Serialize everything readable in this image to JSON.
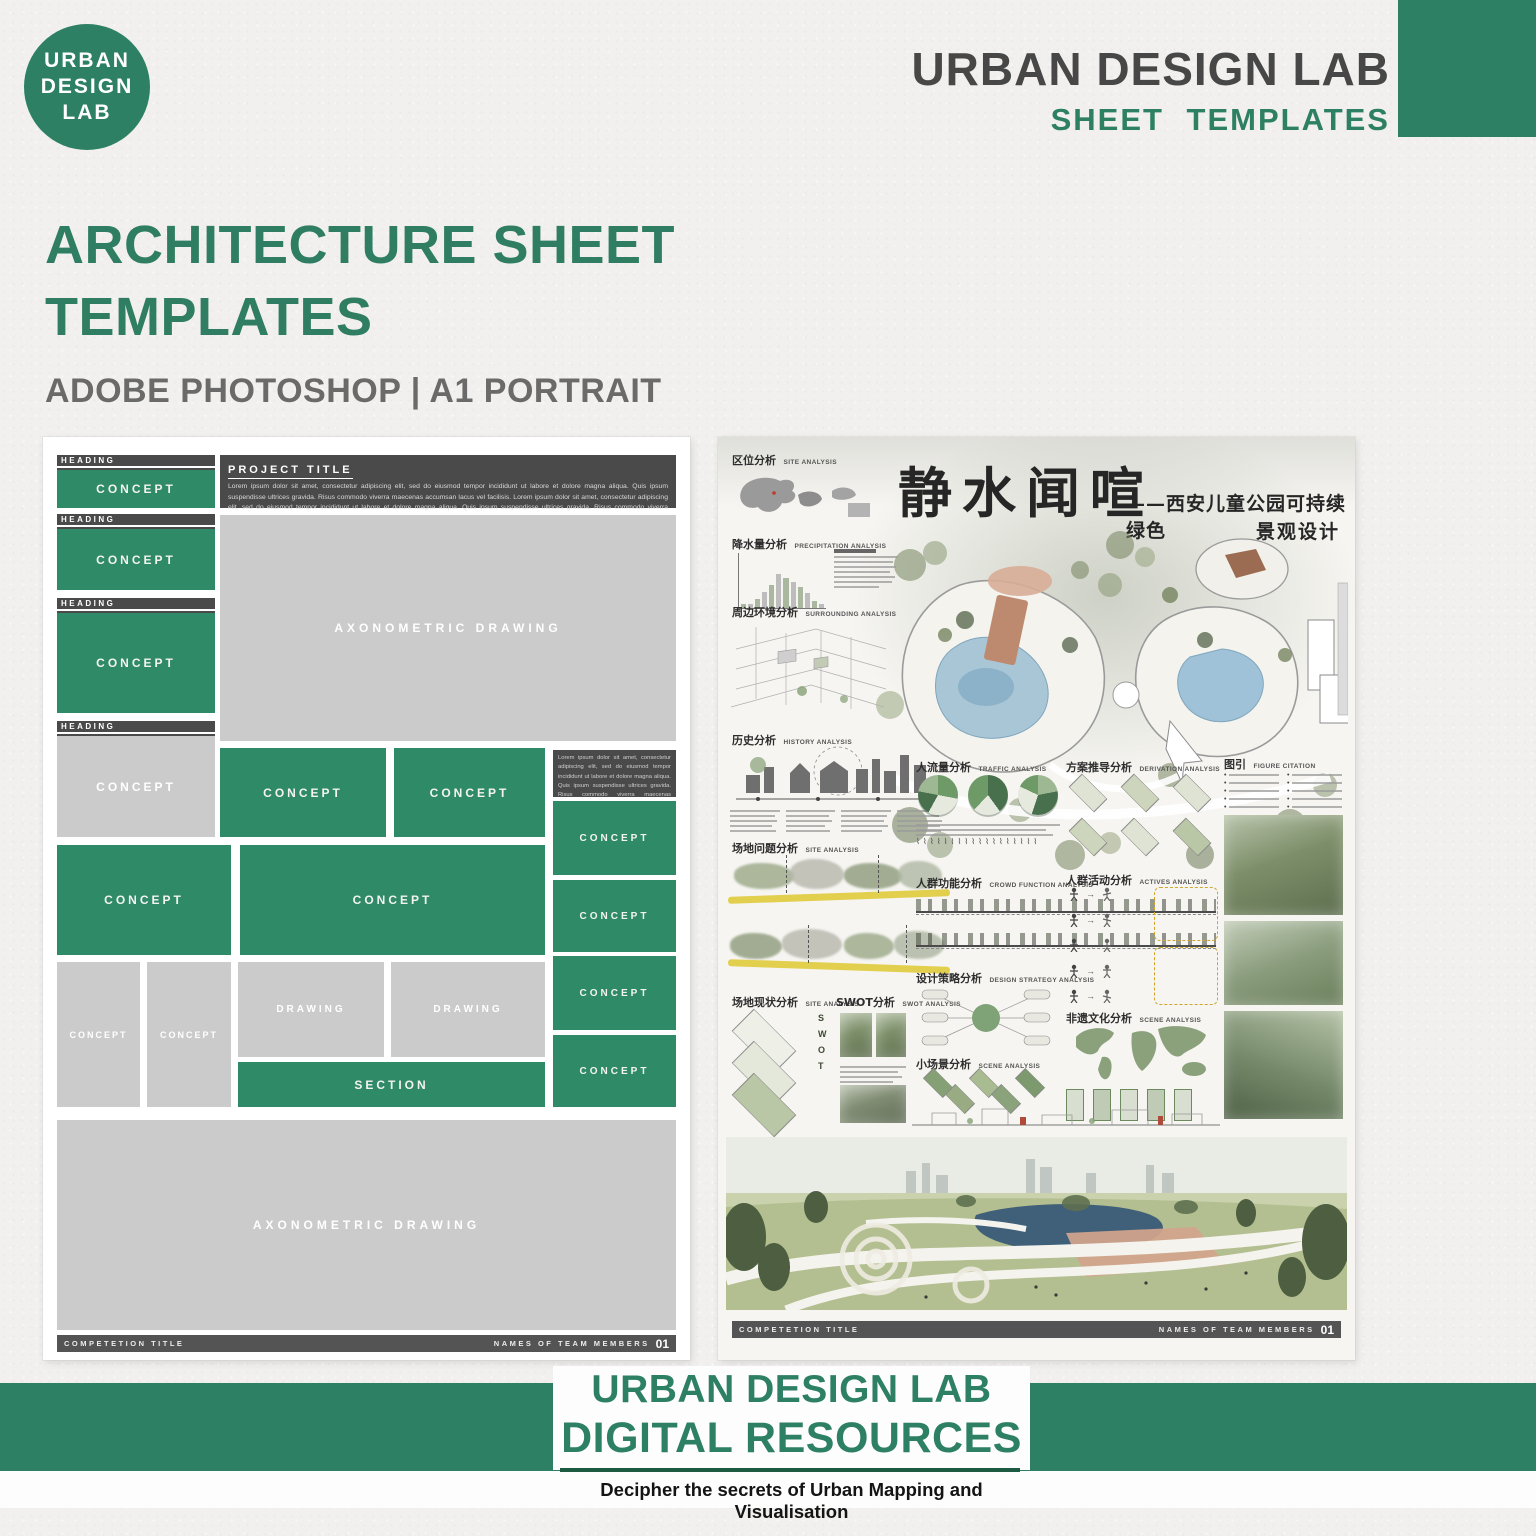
{
  "colors": {
    "brand_green": "#2E8064",
    "template_green": "#2F8A68",
    "dark_gray": "#4A4A4A",
    "block_gray": "#CBCBCB",
    "hero_green": "#2F7D62"
  },
  "header": {
    "logo_lines": [
      "URBAN",
      "DESIGN",
      "LAB"
    ],
    "brand_title": "URBAN DESIGN LAB",
    "brand_subtitle": "SHEET TEMPLATES"
  },
  "hero": {
    "title_line1": "ARCHITECTURE SHEET",
    "title_line2": "TEMPLATES",
    "subtitle": "ADOBE PHOTOSHOP | A1 PORTRAIT"
  },
  "template_sheet": {
    "heading_label": "HEADING",
    "concept_label": "CONCEPT",
    "project_title_label": "PROJECT TITLE",
    "project_title_body": "Lorem ipsum dolor sit amet, consectetur adipiscing elit, sed do eiusmod tempor incididunt ut labore et dolore magna aliqua. Quis ipsum suspendisse ultrices gravida. Risus commodo viverra maecenas accumsan lacus vel facilisis. Lorem ipsum dolor sit amet, consectetur adipiscing elit, sed do eiusmod tempor incididunt ut labore et dolore magna aliqua. Quis ipsum suspendisse ultrices gravida. Risus commodo viverra maecenas accumsan lacus vel facilisis. Lorem",
    "side_note_body": "Lorem ipsum dolor sit amet, consectetur adipiscing elit, sed do eiusmod tempor incididunt ut labore et dolore magna aliqua. Quis ipsum suspendisse ultrices gravida. Risus commodo viverra maecenas accumsan lacus vel facilisis. Lorem ipsum dolor sit amet, consectetur",
    "axonometric_label": "AXONOMETRIC DRAWING",
    "drawing_label": "DRAWING",
    "section_label": "SECTION",
    "footer_left": "COMPETETION TITLE",
    "footer_right": "NAMES OF TEAM MEMBERS",
    "footer_page": "01"
  },
  "example_sheet": {
    "title_main": "静水闻喧",
    "title_sub_line1": "——西安儿童公园可持续绿色",
    "title_sub_line2": "景观设计",
    "sections": {
      "site": {
        "zh": "区位分析",
        "en": "SITE ANALYSIS"
      },
      "precipitation": {
        "zh": "降水量分析",
        "en": "PRECIPITATION ANALYSIS"
      },
      "surrounding": {
        "zh": "周边环境分析",
        "en": "SURROUNDING ANALYSIS"
      },
      "history": {
        "zh": "历史分析",
        "en": "HISTORY ANALYSIS"
      },
      "site_problem": {
        "zh": "场地问题分析",
        "en": "SITE ANALYSIS"
      },
      "site_status": {
        "zh": "场地现状分析",
        "en": "SITE ANALYSIS"
      },
      "swot": {
        "zh": "SWOT分析",
        "en": "SWOT ANALYSIS"
      },
      "traffic": {
        "zh": "人流量分析",
        "en": "TRAFFIC ANALYSIS"
      },
      "crowd_function": {
        "zh": "人群功能分析",
        "en": "CROWD FUNCTION ANALYSIS"
      },
      "design_strategy": {
        "zh": "设计策略分析",
        "en": "DESIGN STRATEGY ANALYSIS"
      },
      "scene_small": {
        "zh": "小场景分析",
        "en": "SCENE ANALYSIS"
      },
      "derivation": {
        "zh": "方案推导分析",
        "en": "DERIVATION ANALYSIS"
      },
      "activities": {
        "zh": "人群活动分析",
        "en": "ACTIVES ANALYSIS"
      },
      "heritage": {
        "zh": "非遗文化分析",
        "en": "SCENE ANALYSIS"
      },
      "figure_citation": {
        "zh": "图引",
        "en": "FIGURE CITATION"
      }
    },
    "swot_letters": [
      "S",
      "W",
      "O",
      "T"
    ],
    "precipitation": {
      "values": [
        8,
        8,
        16,
        30,
        42,
        62,
        55,
        47,
        38,
        27,
        12,
        7
      ]
    },
    "footer_left": "COMPETETION TITLE",
    "footer_right": "NAMES OF TEAM MEMBERS",
    "footer_page": "01"
  },
  "footer_banner": {
    "line1": "URBAN DESIGN LAB",
    "line2": "DIGITAL RESOURCES",
    "tagline": "Decipher the secrets of Urban Mapping and Visualisation"
  }
}
